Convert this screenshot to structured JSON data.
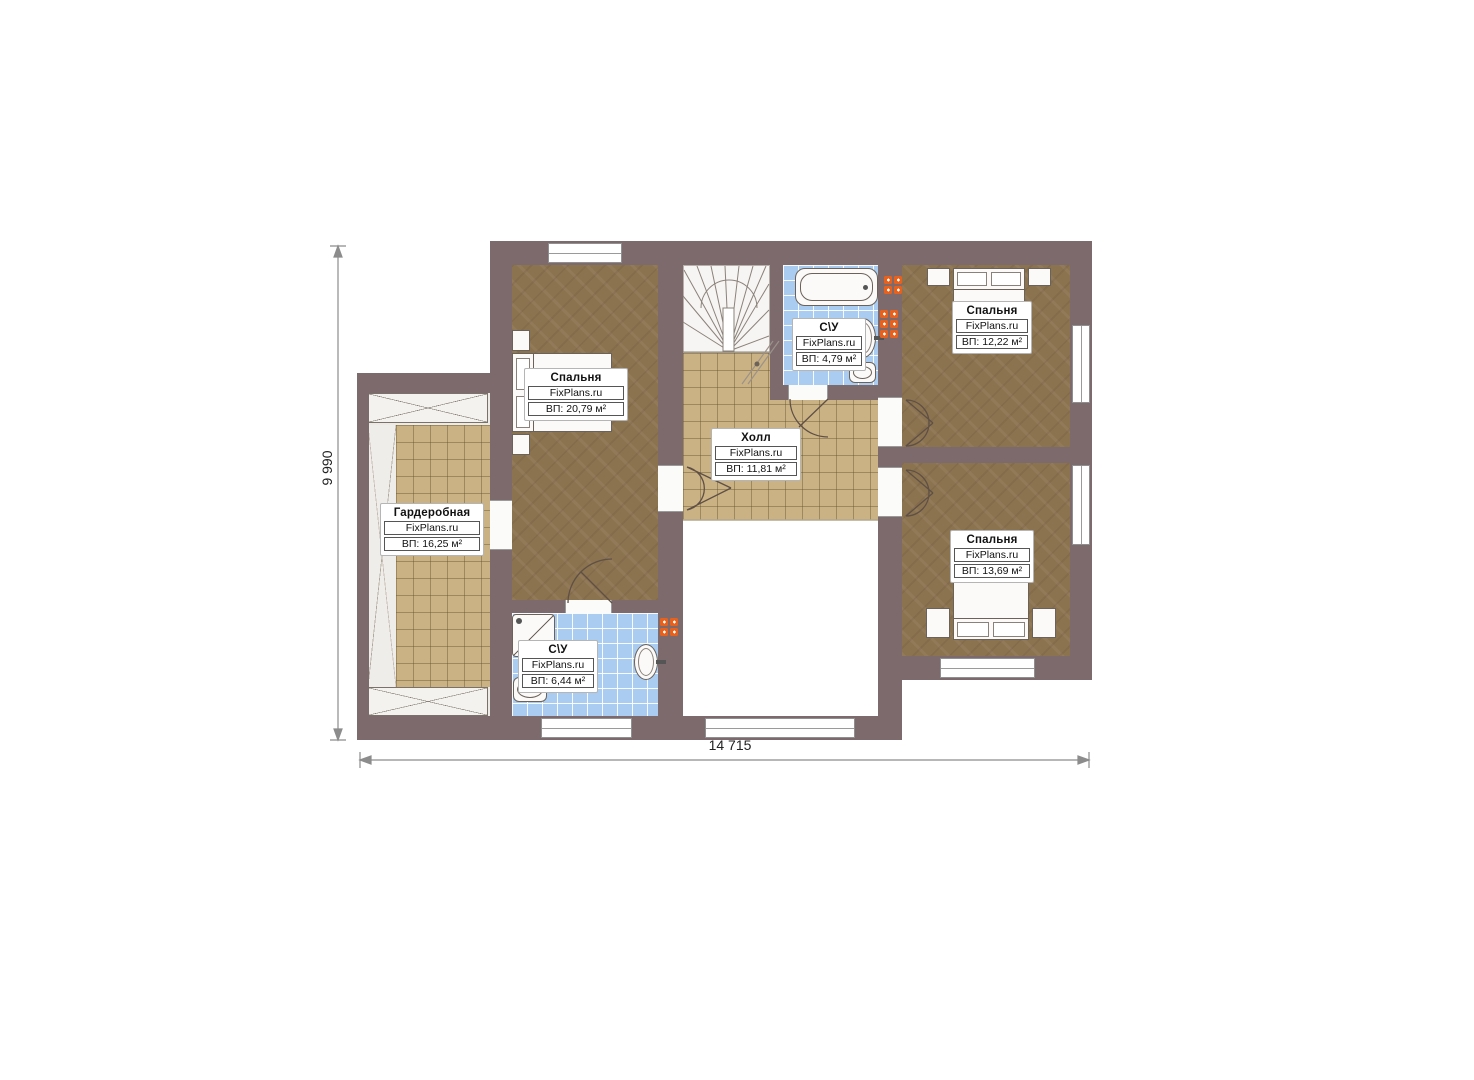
{
  "plan": {
    "brand": "FixPlans.ru",
    "dimension_width": "14 715",
    "dimension_height": "9 990",
    "rooms": [
      {
        "key": "bedroom-left",
        "title": "Спальня",
        "area": "ВП: 20,79 м²"
      },
      {
        "key": "wardrobe",
        "title": "Гардеробная",
        "area": "ВП: 16,25 м²"
      },
      {
        "key": "hall",
        "title": "Холл",
        "area": "ВП: 11,81 м²"
      },
      {
        "key": "bathroom-top",
        "title": "С\\У",
        "area": "ВП: 4,79 м²"
      },
      {
        "key": "bedroom-top-right",
        "title": "Спальня",
        "area": "ВП: 12,22 м²"
      },
      {
        "key": "bedroom-right",
        "title": "Спальня",
        "area": "ВП: 13,69 м²"
      },
      {
        "key": "bathroom-bottom",
        "title": "С\\У",
        "area": "ВП: 6,44 м²"
      }
    ],
    "colors": {
      "wall": "#7d6a6c",
      "bedroom_floor": "#8c7350",
      "tile_floor": "#cbb284",
      "bath_floor": "#a9ccf0",
      "radiator": "#e8611c"
    }
  }
}
